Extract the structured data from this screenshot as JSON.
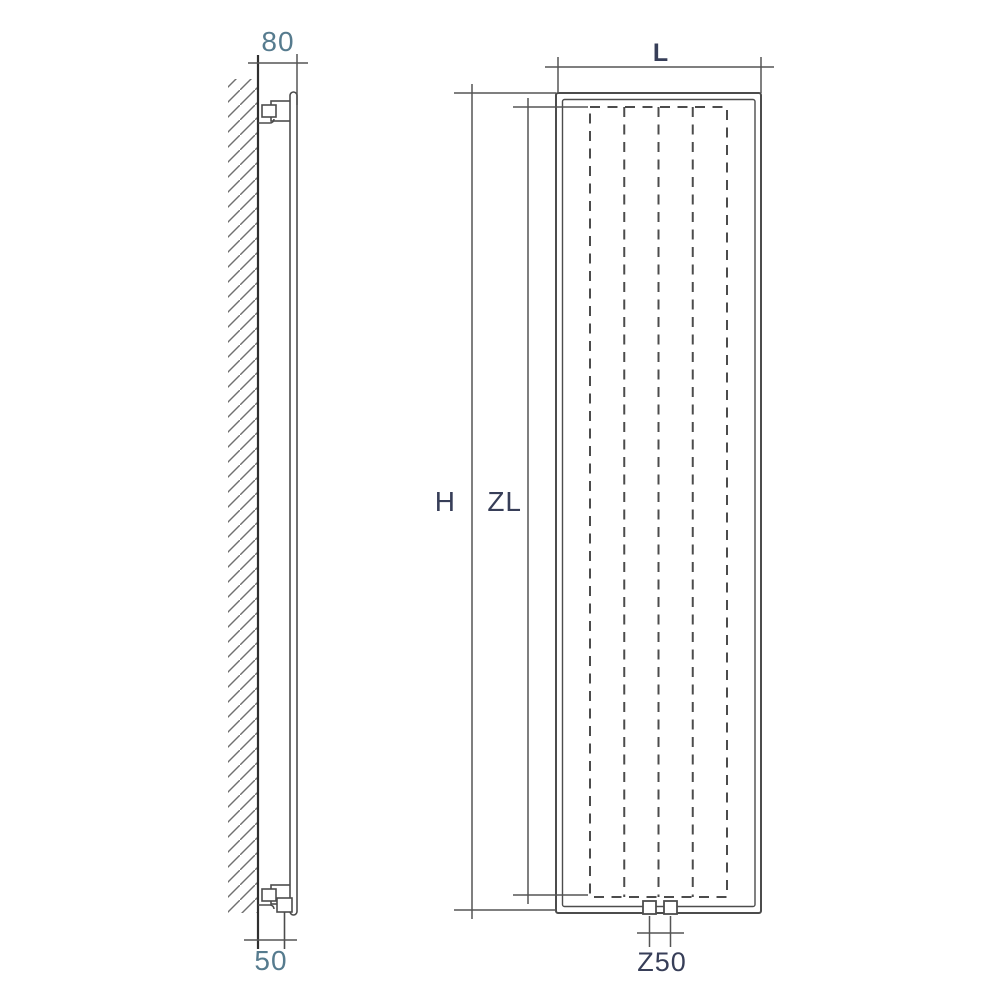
{
  "figure": {
    "description": "radiator-dimension-drawing",
    "labels": {
      "wall_offset_top": "80",
      "wall_offset_bottom": "50",
      "width": "L",
      "height": "H",
      "element_length": "ZL",
      "connection_spacing": "Z50"
    }
  },
  "colors": {
    "background": "#ffffff",
    "line": "#4c4c4c",
    "wall_line": "#2f2f2f",
    "hatch": "#707070",
    "label_primary": "#373e58",
    "label_secondary": "#567b8e"
  }
}
